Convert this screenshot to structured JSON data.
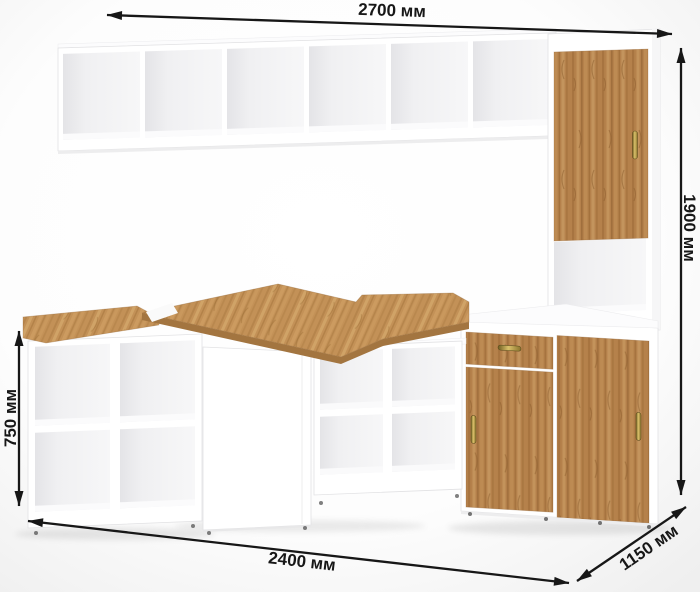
{
  "dimensions": {
    "top_width": {
      "label": "2700 мм"
    },
    "height": {
      "label": "1900 мм"
    },
    "desk_height": {
      "label": "750 мм"
    },
    "bottom_width": {
      "label": "2400 мм"
    },
    "depth": {
      "label": "1150 мм"
    }
  },
  "colors": {
    "wood": "#b5814b",
    "wood_top": "#c39157",
    "wood_edge": "#a37540",
    "brass": "#d9c06a",
    "arrow": "#171717",
    "white": "#ffffff",
    "background_edge": "#efefef"
  }
}
